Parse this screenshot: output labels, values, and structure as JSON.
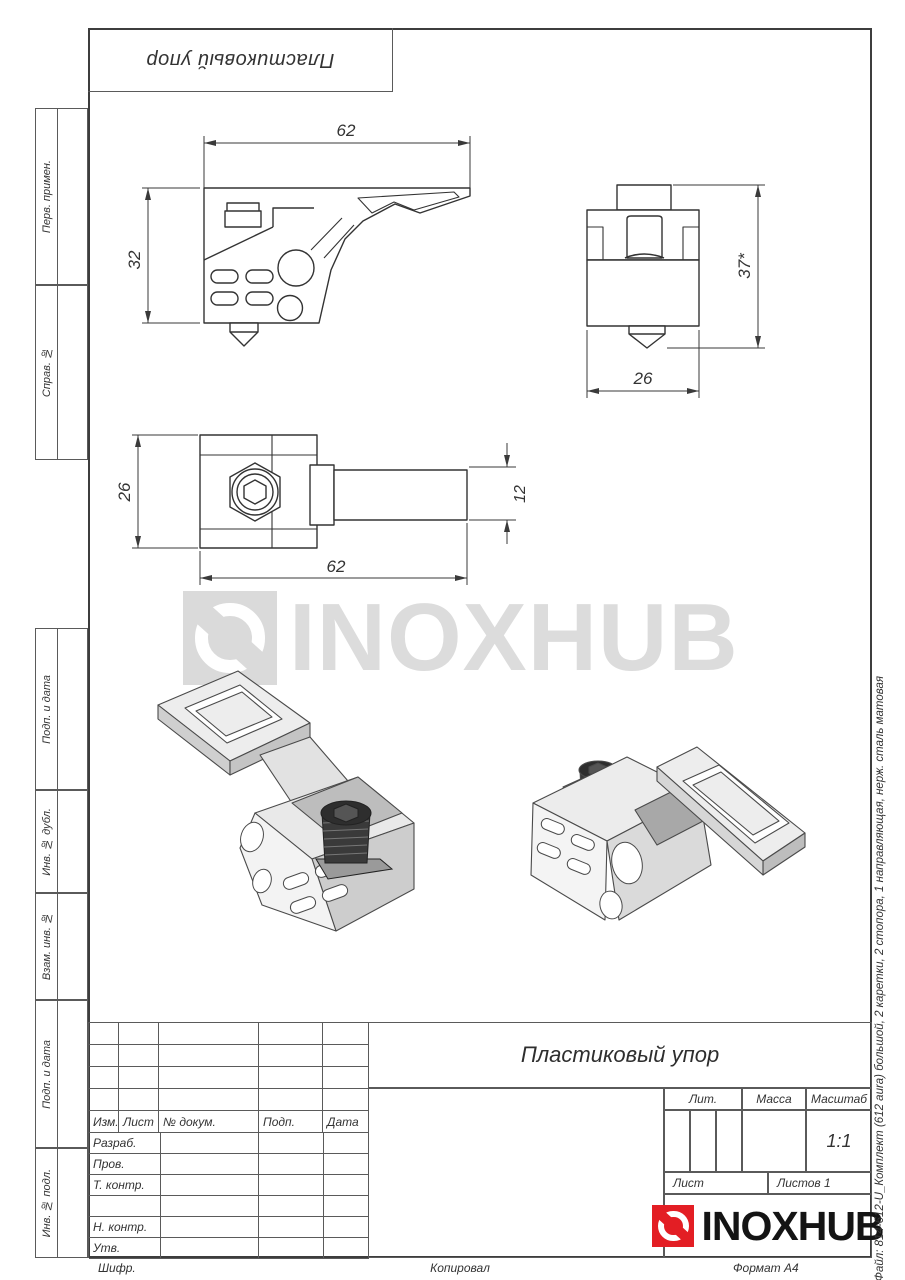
{
  "sheet": {
    "top_stamp_text": "Пластиковый упор",
    "left_margin": [
      {
        "label": "Перв. примен."
      },
      {
        "label": "Справ. №"
      },
      {
        "label": "Подп. и дата"
      },
      {
        "label": "Инв. № дубл."
      },
      {
        "label": "Взам. инв. №"
      },
      {
        "label": "Подп. и дата"
      },
      {
        "label": "Инв. № подл."
      }
    ],
    "right_margin_file_text": "Файл: 814-612-U_Комплект (612 aura) большой, 2 каретки, 2 стопора, 1 направляющая, нерж. сталь матовая",
    "footer": {
      "cipher": "Шифр.",
      "copied": "Копировал",
      "format": "Формат А4"
    }
  },
  "drawing": {
    "part_name": "Пластиковый упор",
    "dimensions": {
      "front_width": "62",
      "front_height": "32",
      "side_height": "37*",
      "side_width": "26",
      "top_height": "26",
      "top_arm_height": "12",
      "top_width": "62"
    }
  },
  "watermark": {
    "brand": "INOXHUB"
  },
  "title_block": {
    "title": "Пластиковый упор",
    "header_cells": [
      "Изм.",
      "Лист",
      "№ докум.",
      "Подп.",
      "Дата"
    ],
    "rows": [
      "Разраб.",
      "Пров.",
      "Т. контр.",
      "",
      "Н. контр.",
      "Утв."
    ],
    "lit_label": "Лит.",
    "mass_label": "Масса",
    "scale_label": "Масштаб",
    "scale_value": "1:1",
    "sheet_label": "Лист",
    "sheets_label": "Листов 1",
    "brand": "INOXHUB"
  },
  "colors": {
    "accent_red": "#e31e24",
    "line": "#3a3a3a",
    "watermark": "#dcdcdc"
  }
}
